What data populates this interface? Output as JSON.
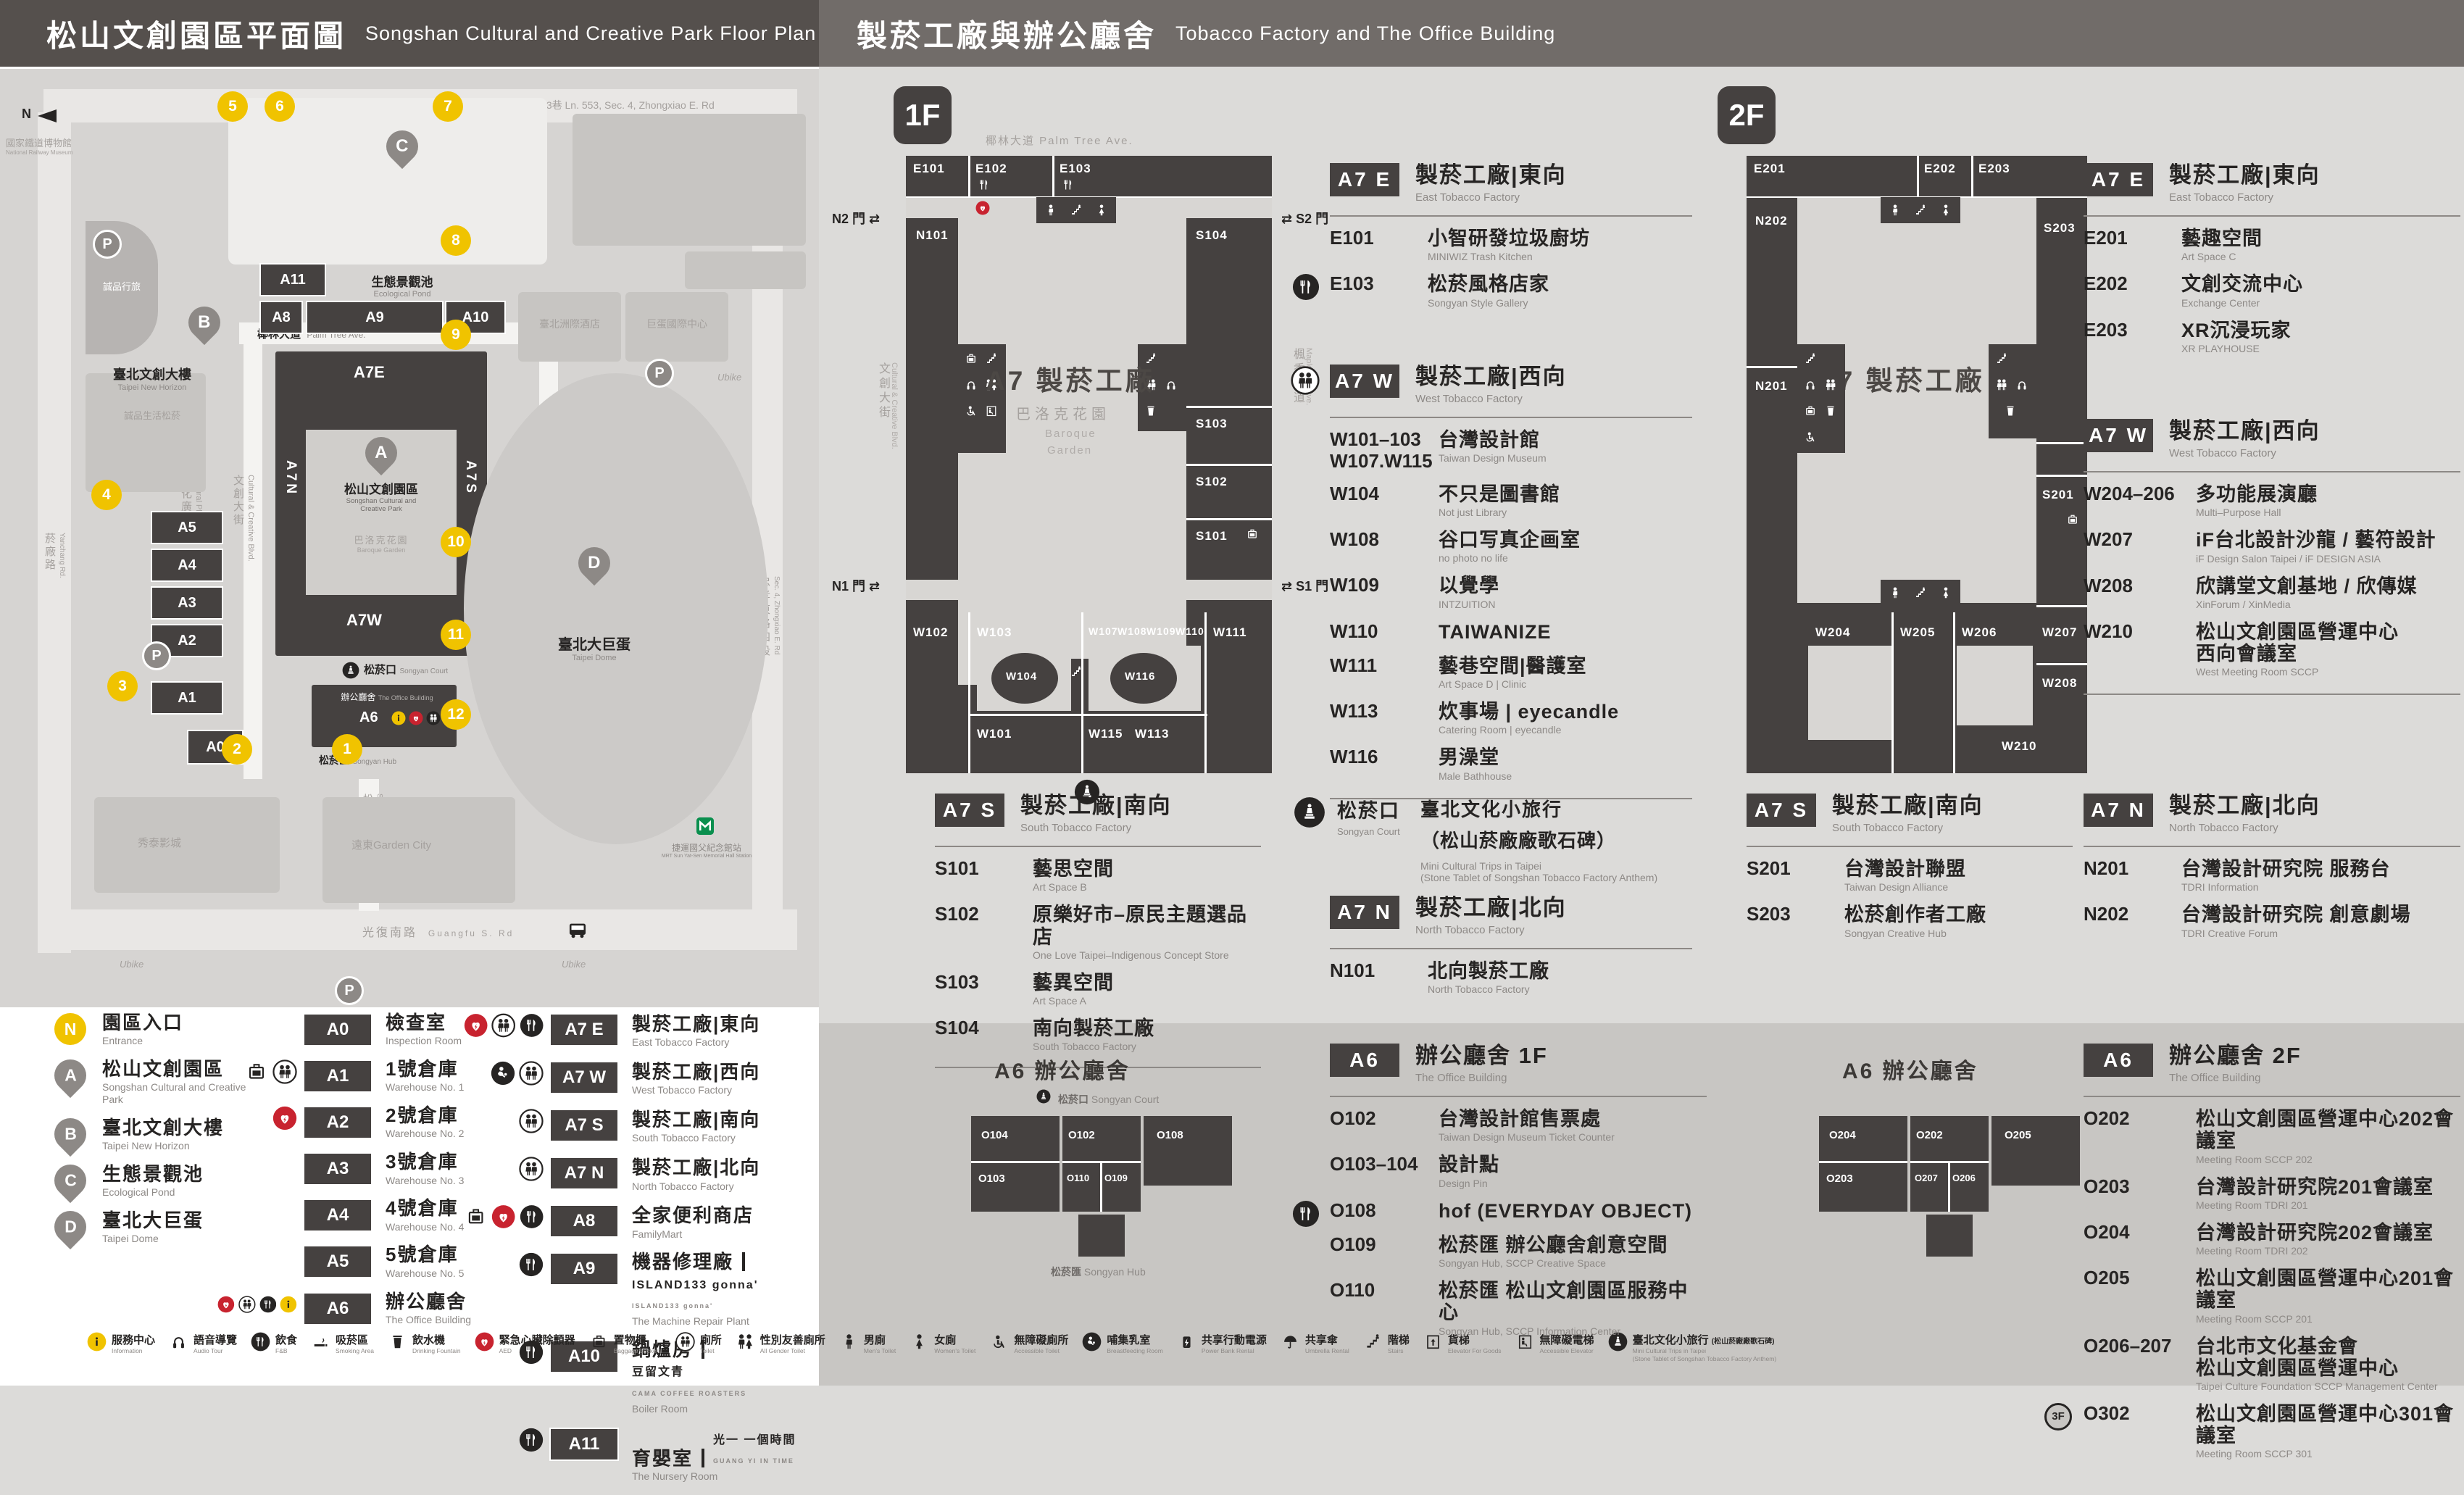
{
  "header": {
    "zh_left": "松山文創園區平面圖",
    "en_left": "Songshan Cultural and Creative Park Floor Plan",
    "zh_right": "製菸工廠與辦公廳舍",
    "en_right": "Tobacco Factory and The Office Building"
  },
  "map": {
    "north": "N",
    "museum_zh": "國家鐵道博物館",
    "museum_en": "National Railway Museum",
    "pond_zh": "生態景觀池",
    "pond_en": "Ecological Pond",
    "eslite_hotel": "誠品行旅",
    "new_horizon_zh": "臺北文創大樓",
    "new_horizon_en": "Taipei New Horizon",
    "eslite_spectrum": "誠品生活松菸",
    "intercontinental": "臺北洲際酒店",
    "dome_intl": "巨蛋國際中心",
    "dome_zh": "臺北大巨蛋",
    "dome_en": "Taipei Dome",
    "cinema": "秀泰影城",
    "garden_city": "遠東Garden City",
    "mrt_zh": "捷運國父紀念館站",
    "mrt_en": "MRT Sun Yat-Sen Memorial Hall Station",
    "ubike": "Ubike",
    "park_pin_zh": "松山文創園區",
    "park_pin_en1": "Songshan Cultural and",
    "park_pin_en2": "Creative Park",
    "baroque_zh": "巴洛克花園",
    "baroque_en": "Baroque Garden",
    "court_zh": "松菸口",
    "court_en": "Songyan Court",
    "office_zh": "辦公廳舍",
    "office_en": "The Office Building",
    "hub_zh": "松菸匯",
    "hub_en": "Songyan Hub",
    "codes": {
      "a0": "A0",
      "a1": "A1",
      "a2": "A2",
      "a3": "A3",
      "a4": "A4",
      "a5": "A5",
      "a6": "A6",
      "a7e": "A7E",
      "a7w": "A7W",
      "a7n": "A7N",
      "a7s": "A7S",
      "a8": "A8",
      "a9": "A9",
      "a10": "A10",
      "a11": "A11"
    },
    "pins": {
      "a": "A",
      "b": "B",
      "c": "C",
      "d": "D"
    },
    "entrances": [
      "1",
      "2",
      "3",
      "4",
      "5",
      "6",
      "7",
      "8",
      "9",
      "10",
      "11",
      "12"
    ],
    "roads": {
      "lane": "忠孝東路四段553巷 Ln. 553, Sec. 4, Zhongxiao E. Rd",
      "palm_zh": "椰林大道",
      "palm_en": "Palm Tree Ave.",
      "cc_blvd_zh": "文創大街",
      "cc_blvd_en": "Cultural & Creative Blvd.",
      "plaza_zh": "文化廣場",
      "plaza_en": "Cultural Plaza",
      "maple_zh": "楓香大道",
      "maple_en": "Maple Tree Ave.",
      "yanchang_zh": "菸廠路",
      "yanchang_en": "Yanchang Rd.",
      "songyan_zh": "松菸大道",
      "songyan_en": "Songyan Ave.",
      "guangfu_zh": "光復南路",
      "guangfu_en": "Guangfu S. Rd",
      "zhongxiao_zh": "忠孝東路四段",
      "zhongxiao_en": "Sec. 4, Zhongxiao E. Rd"
    }
  },
  "legend": {
    "col1": [
      {
        "badge": "N",
        "kind": "entrance",
        "zh": "園區入口",
        "en": "Entrance"
      },
      {
        "badge": "A",
        "kind": "pin",
        "zh": "松山文創園區",
        "en": "Songshan Cultural and Creative Park"
      },
      {
        "badge": "B",
        "kind": "pin",
        "zh": "臺北文創大樓",
        "en": "Taipei New Horizon"
      },
      {
        "badge": "C",
        "kind": "pin",
        "zh": "生態景觀池",
        "en": "Ecological Pond"
      },
      {
        "badge": "D",
        "kind": "pin",
        "zh": "臺北大巨蛋",
        "en": "Taipei Dome"
      }
    ],
    "col2": [
      {
        "code": "A0",
        "zh": "檢查室",
        "en": "Inspection Room",
        "icons": []
      },
      {
        "code": "A1",
        "zh": "1號倉庫",
        "en": "Warehouse No. 1",
        "icons": [
          "locker",
          "toilet"
        ]
      },
      {
        "code": "A2",
        "zh": "2號倉庫",
        "en": "Warehouse No. 2",
        "icons": [
          "aed"
        ]
      },
      {
        "code": "A3",
        "zh": "3號倉庫",
        "en": "Warehouse No. 3",
        "icons": []
      },
      {
        "code": "A4",
        "zh": "4號倉庫",
        "en": "Warehouse No. 4",
        "icons": []
      },
      {
        "code": "A5",
        "zh": "5號倉庫",
        "en": "Warehouse No. 5",
        "icons": []
      },
      {
        "code": "A6",
        "zh": "辦公廳舍",
        "en": "The Office Building",
        "icons": [
          "aed",
          "toilet",
          "fnb",
          "info"
        ]
      }
    ],
    "col3": [
      {
        "code": "A7 E",
        "zh": "製菸工廠|東向",
        "en": "East Tobacco Factory",
        "icons": [
          "aed",
          "toilet",
          "fnb"
        ]
      },
      {
        "code": "A7 W",
        "zh": "製菸工廠|西向",
        "en": "West Tobacco Factory",
        "icons": [
          "breastfeeding",
          "toilet"
        ]
      },
      {
        "code": "A7 S",
        "zh": "製菸工廠|南向",
        "en": "South Tobacco Factory",
        "icons": [
          "toilet"
        ]
      },
      {
        "code": "A7 N",
        "zh": "製菸工廠|北向",
        "en": "North Tobacco Factory",
        "icons": [
          "toilet"
        ]
      },
      {
        "code": "A8",
        "zh": "全家便利商店",
        "en": "FamilyMart",
        "icons": [
          "locker",
          "aed",
          "fnb"
        ]
      },
      {
        "code": "A9",
        "zh": "機器修理廠",
        "en": "The Machine Repair Plant",
        "icons": [
          "fnb"
        ],
        "extra_zh": "ISLAND133 gonna'",
        "extra_en": "ISLAND133 gonna'"
      },
      {
        "code": "A10",
        "zh": "鍋爐房",
        "en": "Boiler Room",
        "icons": [
          "fnb"
        ],
        "extra_zh": "豆留文青",
        "extra_en": "CAMA COFFEE ROASTERS"
      },
      {
        "code": "A11",
        "zh": "育嬰室",
        "en": "The Nursery Room",
        "icons": [
          "fnb"
        ],
        "extra_zh": "光一 一個時間",
        "extra_en": "GUANG YI IN TIME"
      }
    ]
  },
  "facilities": [
    {
      "icon": "info",
      "zh": "服務中心",
      "en": "Information"
    },
    {
      "icon": "audio",
      "zh": "語音導覽",
      "en": "Audio Tour"
    },
    {
      "icon": "fnb",
      "zh": "飲食",
      "en": "F&B"
    },
    {
      "icon": "smoking",
      "zh": "吸菸區",
      "en": "Smoking Area"
    },
    {
      "icon": "fountain",
      "zh": "飲水機",
      "en": "Drinking Fountain"
    },
    {
      "icon": "aed",
      "zh": "緊急心臟除顫器",
      "en": "AED"
    },
    {
      "icon": "locker",
      "zh": "置物櫃",
      "en": "Baggage Lockers"
    },
    {
      "icon": "toilet",
      "zh": "廁所",
      "en": "Toilet"
    },
    {
      "icon": "toilet-ag",
      "zh": "性別友善廁所",
      "en": "All Gender Toilet"
    },
    {
      "icon": "male",
      "zh": "男廁",
      "en": "Men's Toilet"
    },
    {
      "icon": "female",
      "zh": "女廁",
      "en": "Women's Toilet"
    },
    {
      "icon": "wheelchair",
      "zh": "無障礙廁所",
      "en": "Accessible Toilet"
    },
    {
      "icon": "breastfeeding",
      "zh": "哺集乳室",
      "en": "Breastfeeding Room"
    },
    {
      "icon": "powerbank",
      "zh": "共享行動電源",
      "en": "Power Bank Rental"
    },
    {
      "icon": "umbrella",
      "zh": "共享傘",
      "en": "Umbrella Rental"
    },
    {
      "icon": "stairs",
      "zh": "階梯",
      "en": "Stairs"
    },
    {
      "icon": "freight",
      "zh": "貨梯",
      "en": "Elevator For Goods"
    },
    {
      "icon": "acc-elevator",
      "zh": "無障礙電梯",
      "en": "Accessible Elevator"
    },
    {
      "icon": "statue",
      "zh": "臺北文化小旅行",
      "zh2": "(松山菸廠廠歌石碑)",
      "en": "Mini Cultural Trips in Taipei",
      "en2": "(Stone Tablet of Songshan Tobacco Factory Anthem)"
    }
  ],
  "floor1": {
    "badge": "1F",
    "a7e": {
      "code": "A7 E",
      "zh": "製菸工廠|東向",
      "en": "East Tobacco Factory",
      "rooms": [
        {
          "code": "E101",
          "zh": "小智研發垃圾廚坊",
          "en": "MINIWIZ Trash Kitchen"
        },
        {
          "code": "E103",
          "zh": "松菸風格店家",
          "en": "Songyan Style Gallery",
          "icon": "fnb"
        }
      ]
    },
    "a7w": {
      "code": "A7 W",
      "zh": "製菸工廠|西向",
      "en": "West Tobacco Factory",
      "rooms": [
        {
          "code": "W101–103",
          "code2": "W107.W115",
          "zh": "台灣設計館",
          "en": "Taiwan Design Museum"
        },
        {
          "code": "W104",
          "zh": "不只是圖書館",
          "en": "Not just Library"
        },
        {
          "code": "W108",
          "zh": "谷口写真企画室",
          "en": "no photo no life"
        },
        {
          "code": "W109",
          "zh": "以覺學",
          "en": "INTZUITION"
        },
        {
          "code": "W110",
          "zh": "TAIWANIZE",
          "en": ""
        },
        {
          "code": "W111",
          "zh": "藝巷空間|醫護室",
          "en": "Art Space D | Clinic"
        },
        {
          "code": "W113",
          "zh": "炊事場 | eyecandle",
          "en": "Catering Room | eyecandle"
        },
        {
          "code": "W116",
          "zh": "男澡堂",
          "en": "Male Bathhouse"
        }
      ]
    },
    "a7s": {
      "code": "A7 S",
      "zh": "製菸工廠|南向",
      "en": "South Tobacco Factory",
      "rooms": [
        {
          "code": "S101",
          "zh": "藝思空間",
          "en": "Art Space B"
        },
        {
          "code": "S102",
          "zh": "原樂好市–原民主題選品店",
          "en": "One Love Taipei–Indigenous Concept Store"
        },
        {
          "code": "S103",
          "zh": "藝異空間",
          "en": "Art Space A"
        },
        {
          "code": "S104",
          "zh": "南向製菸工廠",
          "en": "South Tobacco Factory"
        }
      ]
    },
    "a7n": {
      "code": "A7 N",
      "zh": "製菸工廠|北向",
      "en": "North Tobacco Factory",
      "rooms": [
        {
          "code": "N101",
          "zh": "北向製菸工廠",
          "en": "North Tobacco Factory"
        }
      ]
    },
    "court": {
      "zh": "松菸口",
      "en": "Songyan Court",
      "t_zh": "臺北文化小旅行",
      "t_zh2": "（松山菸廠廠歌石碑）",
      "t_en": "Mini Cultural Trips in Taipei",
      "t_en2": "(Stone Tablet of Songshan Tobacco Factory Anthem)"
    },
    "diagram": {
      "center": "A7 製菸工廠",
      "baroque_zh": "巴洛克花園",
      "baroque_en1": "Baroque",
      "baroque_en2": "Garden",
      "gates": {
        "n2": "N2 門",
        "s2": "S2 門",
        "n1": "N1 門",
        "s1": "S1 門"
      },
      "streets": {
        "top": "椰林大道  Palm Tree Ave.",
        "left_zh": "文創大街",
        "left_en": "Cultural & Creative Blvd.",
        "right_zh": "楓香大道",
        "right_en": "Maple Tree Ave."
      },
      "rooms": {
        "e101": "E101",
        "e102": "E102",
        "e103": "E103",
        "n101": "N101",
        "s101": "S101",
        "s102": "S102",
        "s103": "S103",
        "s104": "S104",
        "w101": "W101",
        "w102": "W102",
        "w103": "W103",
        "w104": "W104",
        "w107": "W107",
        "w108": "W108",
        "w109": "W109",
        "w110": "W110",
        "w111": "W111",
        "w113": "W113",
        "w115": "W115",
        "w116": "W116"
      }
    }
  },
  "floor2": {
    "badge": "2F",
    "a7e": {
      "code": "A7 E",
      "zh": "製菸工廠|東向",
      "en": "East Tobacco Factory",
      "rooms": [
        {
          "code": "E201",
          "zh": "藝趣空間",
          "en": "Art Space C"
        },
        {
          "code": "E202",
          "zh": "文創交流中心",
          "en": "Exchange Center"
        },
        {
          "code": "E203",
          "zh": "XR沉浸玩家",
          "en": "XR PLAYHOUSE"
        }
      ]
    },
    "a7w": {
      "code": "A7 W",
      "zh": "製菸工廠|西向",
      "en": "West Tobacco Factory",
      "rooms": [
        {
          "code": "W204–206",
          "zh": "多功能展演廳",
          "en": "Multi–Purpose Hall"
        },
        {
          "code": "W207",
          "zh": "iF台北設計沙龍 / 藝符設計",
          "en": "iF Design Salon Taipei / iF DESIGN ASIA"
        },
        {
          "code": "W208",
          "zh": "欣講堂文創基地 / 欣傳媒",
          "en": "XinForum / XinMedia"
        },
        {
          "code": "W210",
          "zh": "松山文創園區營運中心",
          "zh2": "西向會議室",
          "en": "West Meeting Room SCCP"
        }
      ]
    },
    "a7s": {
      "code": "A7 S",
      "zh": "製菸工廠|南向",
      "en": "South Tobacco Factory",
      "rooms": [
        {
          "code": "S201",
          "zh": "台灣設計聯盟",
          "en": "Taiwan Design Alliance"
        },
        {
          "code": "S203",
          "zh": "松菸創作者工廠",
          "en": "Songyan Creative Hub"
        }
      ]
    },
    "a7n": {
      "code": "A7 N",
      "zh": "製菸工廠|北向",
      "en": "North Tobacco Factory",
      "rooms": [
        {
          "code": "N201",
          "zh": "台灣設計研究院 服務台",
          "en": "TDRI Information"
        },
        {
          "code": "N202",
          "zh": "台灣設計研究院 創意劇場",
          "en": "TDRI Creative Forum"
        }
      ]
    },
    "diagram": {
      "center": "A7 製菸工廠",
      "rooms": {
        "e201": "E201",
        "e202": "E202",
        "e203": "E203",
        "n201": "N201",
        "n202": "N202",
        "s201": "S201",
        "s203": "S203",
        "w204": "W204",
        "w205": "W205",
        "w206": "W206",
        "w207": "W207",
        "w208": "W208",
        "w210": "W210"
      }
    }
  },
  "office": {
    "f1": {
      "badge": "A6",
      "zh": "辦公廳舍 1F",
      "en": "The Office Building",
      "diagram_title": "A6 辦公廳舍",
      "court_zh": "松菸口",
      "court_en": "Songyan Court",
      "hub_zh": "松菸匯",
      "hub_en": "Songyan Hub",
      "rooms": [
        {
          "code": "O102",
          "zh": "台灣設計館售票處",
          "en": "Taiwan Design Museum Ticket Counter"
        },
        {
          "code": "O103–104",
          "zh": "設計點",
          "en": "Design Pin"
        },
        {
          "code": "O108",
          "zh": "hof (EVERYDAY OBJECT)",
          "en": "",
          "icon": "fnb"
        },
        {
          "code": "O109",
          "zh": "松菸匯 辦公廳舍創意空間",
          "en": "Songyan Hub, SCCP Creative Space"
        },
        {
          "code": "O110",
          "zh": "松菸匯 松山文創園區服務中心",
          "en": "Songyan Hub, SCCP Information Center"
        }
      ],
      "droom": {
        "o102": "O102",
        "o103": "O103",
        "o104": "O104",
        "o108": "O108",
        "o109": "O109",
        "o110": "O110"
      }
    },
    "f2": {
      "badge": "A6",
      "zh": "辦公廳舍 2F",
      "en": "The Office Building",
      "diagram_title": "A6 辦公廳舍",
      "rooms": [
        {
          "code": "O202",
          "zh": "松山文創園區營運中心202會議室",
          "en": "Meeting Room SCCP 202"
        },
        {
          "code": "O203",
          "zh": "台灣設計研究院201會議室",
          "en": "Meeting Room TDRI 201"
        },
        {
          "code": "O204",
          "zh": "台灣設計研究院202會議室",
          "en": "Meeting Room TDRI 202"
        },
        {
          "code": "O205",
          "zh": "松山文創園區營運中心201會議室",
          "en": "Meeting Room SCCP 201"
        },
        {
          "code": "O206–207",
          "zh": "台北市文化基金會",
          "zh2": "松山文創園區營運中心",
          "en": "Taipei Culture Foundation SCCP Management Center"
        },
        {
          "code": "O302",
          "zh": "松山文創園區營運中心301會議室",
          "en": "Meeting Room SCCP 301",
          "pref": "3F"
        }
      ],
      "droom": {
        "o202": "O202",
        "o203": "O203",
        "o204": "O204",
        "o205": "O205",
        "o206": "O206",
        "o207": "O207"
      }
    }
  }
}
